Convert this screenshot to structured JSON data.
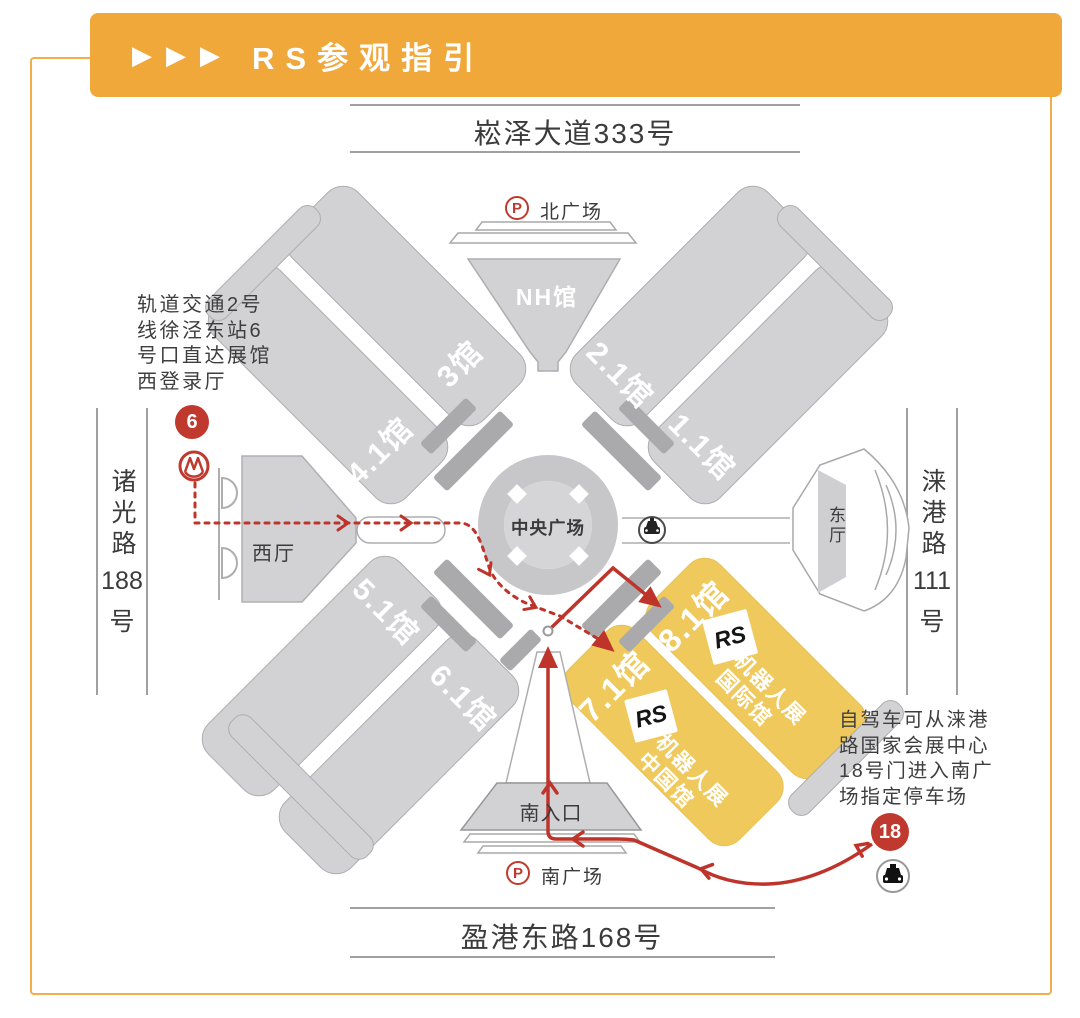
{
  "header": {
    "arrows": "▶▶▶",
    "title": "RS参观指引"
  },
  "roads": {
    "north": "崧泽大道333号",
    "south": "盈港东路168号",
    "west": {
      "name": "诸光路",
      "number": "188",
      "suffix": "号"
    },
    "east": {
      "name": "涞港路",
      "number": "111",
      "suffix": "号"
    }
  },
  "halls": {
    "h3": "3馆",
    "h41": "4.1馆",
    "h21": "2.1馆",
    "h11": "1.1馆",
    "h51": "5.1馆",
    "h61": "6.1馆",
    "h71": "7.1馆",
    "h81": "8.1馆",
    "nh": "NH馆"
  },
  "areas": {
    "central": "中央广场",
    "west_hall": "西厅",
    "east_hall": "东厅",
    "south_entrance": "南入口",
    "north_plaza": "北广场",
    "south_plaza": "南广场"
  },
  "markers": {
    "parking": "P",
    "metro_exit": "6",
    "gate": "18"
  },
  "rs": {
    "logo": "RS",
    "exhibition": "机器人展",
    "intl_hall": "国际馆",
    "china_hall": "中国馆"
  },
  "notes": {
    "metro": [
      "轨道交通2号",
      "线徐泾东站6",
      "号口直达展馆",
      "西登录厅"
    ],
    "drive": [
      "自驾车可从涞港",
      "路国家会展中心",
      "18号门进入南广",
      "场指定停车场"
    ]
  },
  "colors": {
    "accent_orange": "#F1A83B",
    "highlight_yellow": "#EFC95C",
    "route_red": "#BE342B",
    "hall_gray": "#D2D2D4"
  }
}
